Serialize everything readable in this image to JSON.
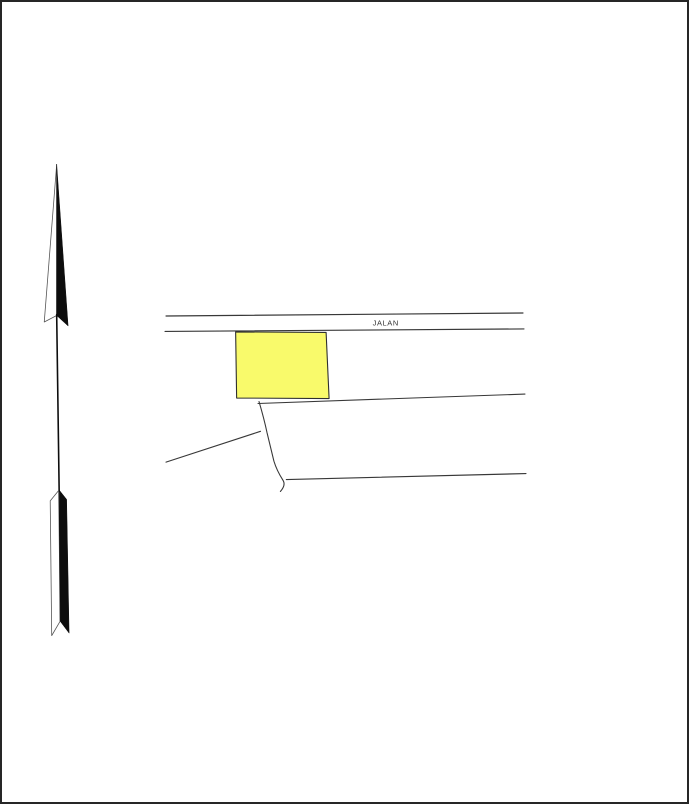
{
  "page": {
    "width": 689,
    "height": 804,
    "background": "#ffffff",
    "border_color": "#262626"
  },
  "map": {
    "road_label": "JALAN",
    "colors": {
      "parcel_fill": "#F9FA6B",
      "line": "#383838",
      "arrow_fill": "#0d0d0d",
      "arrow_outline": "#555555"
    },
    "features": [
      {
        "name": "north-arrow-head-left-half",
        "type": "polygon",
        "points": "55,163 42.5,321.5 55,315",
        "fill": "#ffffff",
        "stroke": "#555555",
        "width": 0.8
      },
      {
        "name": "north-arrow-head-right-half",
        "type": "polygon",
        "points": "55,163 66.5,325.5 55,315",
        "fill": "#0d0d0d",
        "stroke": "#0d0d0d",
        "width": 0.5
      },
      {
        "name": "north-arrow-shaft",
        "type": "line",
        "x1": 55,
        "y1": 314,
        "x2": 57.5,
        "y2": 492,
        "stroke": "#0d0d0d",
        "width": 1.6
      },
      {
        "name": "north-arrow-tail-left-half",
        "type": "polygon",
        "points": "57,491 48.5,501.5 50,637 58.5,622.5",
        "fill": "#ffffff",
        "stroke": "#555555",
        "width": 0.8
      },
      {
        "name": "north-arrow-tail-right-half",
        "type": "polygon",
        "points": "57.5,490.5 65,500 67.5,634.5 58.5,622.5",
        "fill": "#0d0d0d",
        "stroke": "#0d0d0d",
        "width": 0.5
      },
      {
        "name": "road-edge-north",
        "type": "line",
        "x1": 165,
        "y1": 315.5,
        "x2": 524,
        "y2": 312.5,
        "stroke": "#383838",
        "width": 1.2
      },
      {
        "name": "road-edge-south",
        "type": "line",
        "x1": 164,
        "y1": 331,
        "x2": 525,
        "y2": 328.5,
        "stroke": "#383838",
        "width": 1.2
      },
      {
        "name": "road-name-label",
        "type": "text",
        "x": 386,
        "y": 325,
        "text": "JALAN",
        "size": 7.5,
        "fill": "#333333",
        "letter_spacing": 0.6,
        "anchor": "middle"
      },
      {
        "name": "highlighted-parcel",
        "type": "polygon",
        "points": "235,331.5 326,332 329,398.5 236,398",
        "fill": "#F9FA6B",
        "stroke": "#2f2f2f",
        "width": 1.1
      },
      {
        "name": "boundary-line-east",
        "type": "line",
        "x1": 257.5,
        "y1": 403.5,
        "x2": 526,
        "y2": 394,
        "stroke": "#383838",
        "width": 1.1
      },
      {
        "name": "boundary-path-creek",
        "type": "path",
        "d": "M258.5,401.5 C261,410 264.5,423 266.5,432.5 L273.5,461.5 C275,466.5 278,473.5 282.5,480.5 C284.5,483.5 284,487.5 280,492",
        "stroke": "#383838",
        "width": 1.1
      },
      {
        "name": "boundary-line-southwest",
        "type": "line",
        "x1": 260,
        "y1": 431.5,
        "x2": 165,
        "y2": 462.5,
        "stroke": "#383838",
        "width": 1.1
      },
      {
        "name": "boundary-line-south",
        "type": "line",
        "x1": 286,
        "y1": 480,
        "x2": 527,
        "y2": 474,
        "stroke": "#383838",
        "width": 1.2
      }
    ]
  }
}
